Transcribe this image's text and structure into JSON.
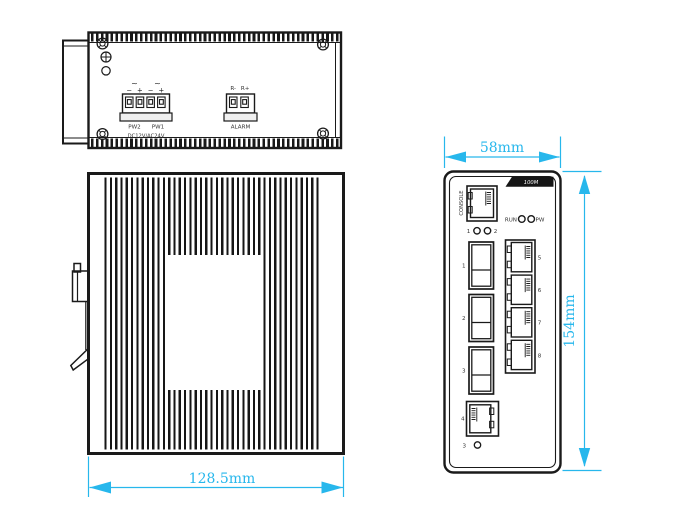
{
  "colors": {
    "line": "#1a1a1a",
    "dimension_accent": "#27b7ec",
    "badge_background": "#151515",
    "badge_text": "#ffffff",
    "background": "#ffffff"
  },
  "top_view": {
    "power_terminal": {
      "ac_mark_1": "~",
      "ac_mark_2": "~",
      "polarity": [
        "−",
        "+",
        "−",
        "+"
      ],
      "pw2": "PW2",
      "pw1": "PW1",
      "rating": "DC12V/AC24V"
    },
    "alarm_terminal": {
      "pin_neg": "R-",
      "pin_pos": "R+",
      "label": "ALARM"
    }
  },
  "front_view": {
    "badge": "100M",
    "console": "CONSOLE",
    "run": "RUN",
    "pw": "PW",
    "led1": "1",
    "led2": "2",
    "led3": "3",
    "sfp": [
      "1",
      "2",
      "3"
    ],
    "ports": [
      "5",
      "6",
      "7",
      "8"
    ],
    "port4": "4"
  },
  "dims": {
    "front_width": "58mm",
    "front_height": "154mm",
    "body_width": "128.5mm"
  }
}
